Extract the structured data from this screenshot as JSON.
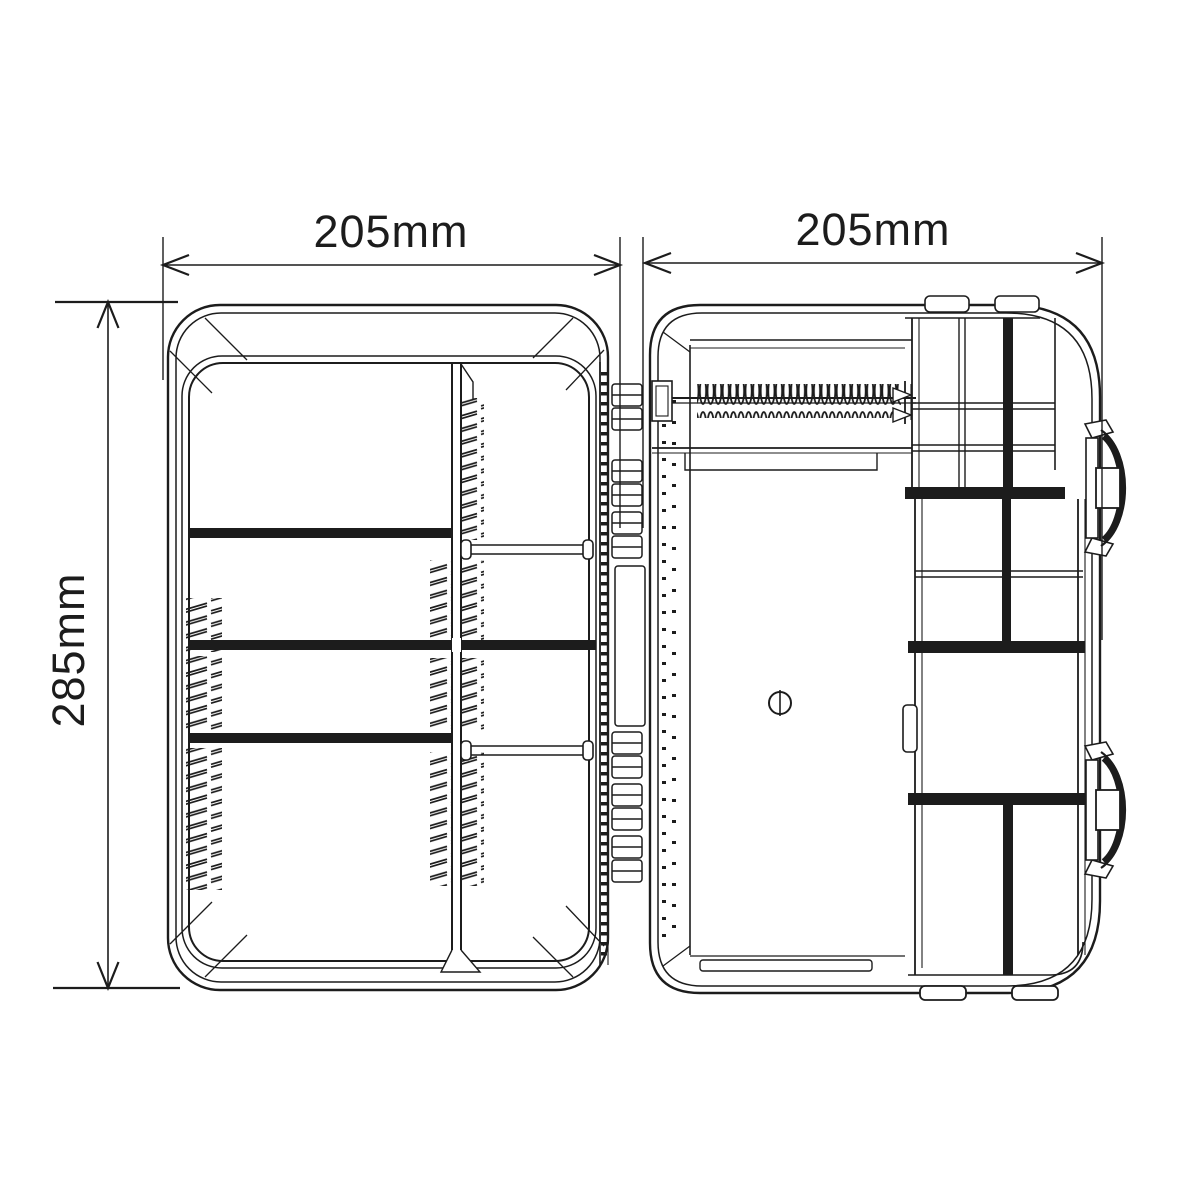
{
  "diagram": {
    "dimension_labels": {
      "left_case_width": "205mm",
      "right_case_width": "205mm",
      "case_height": "285mm"
    },
    "colors": {
      "line": "#1c1c1c",
      "background": "#ffffff"
    }
  }
}
